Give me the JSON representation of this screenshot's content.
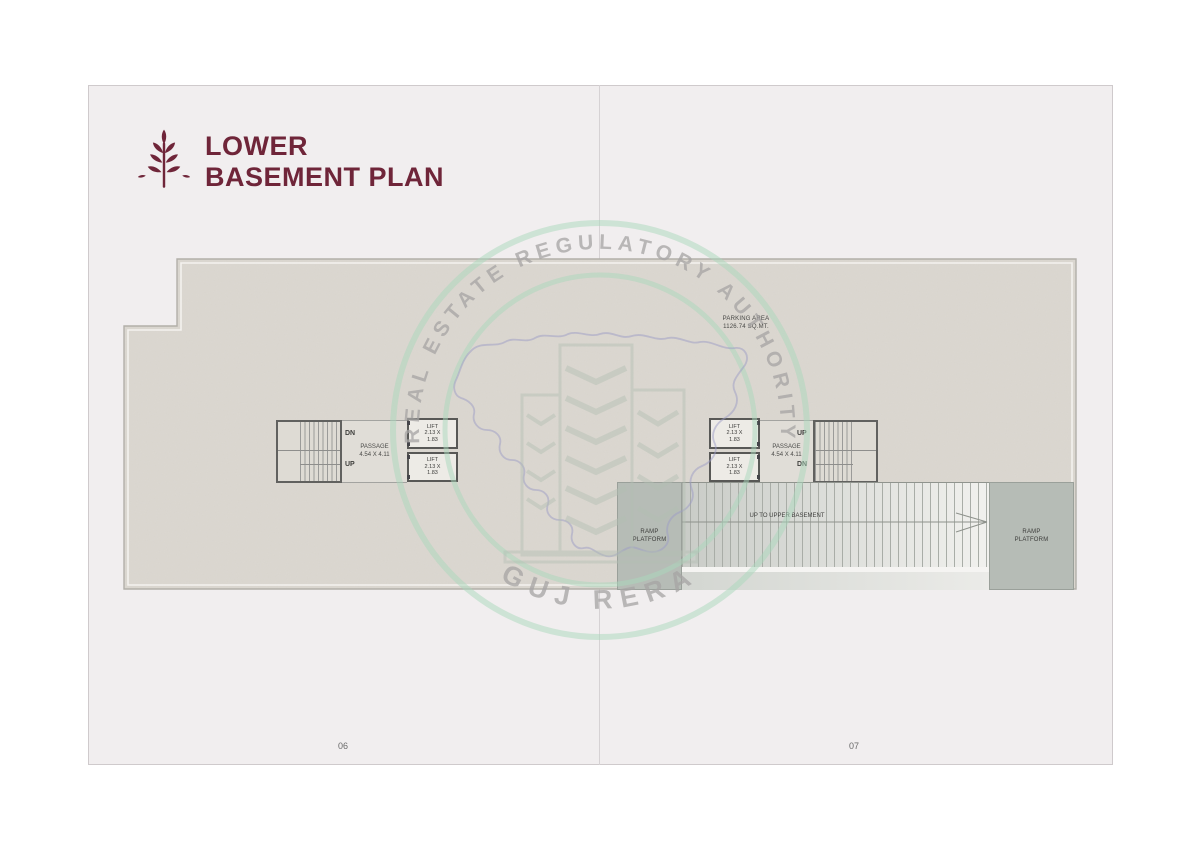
{
  "header": {
    "title_line1": "LOWER",
    "title_line2": "BASEMENT PLAN"
  },
  "watermark": {
    "arc_text": "REAL ESTATE REGULATORY AUTHORITY",
    "bottom_text": "GUJ RERA"
  },
  "colors": {
    "accent_maroon": "#6f2539",
    "watermark_green": "#a9d8bc",
    "plan_fill": "#dcd8d1",
    "platform_fill": "#b6bcb6",
    "wall": "#585856"
  },
  "plan": {
    "parking": {
      "line1": "PARKING AREA",
      "line2": "1126.74 SQ.MT."
    },
    "left_core": {
      "down_label": "DN",
      "up_label": "UP",
      "passage_line1": "PASSAGE",
      "passage_line2": "4.54 X 4.11"
    },
    "right_core": {
      "up_label": "UP",
      "down_label": "DN",
      "passage_line1": "PASSAGE",
      "passage_line2": "4.54 X 4.11"
    },
    "lift": {
      "name": "LIFT",
      "dim_line1": "2.13 X",
      "dim_line2": "1.83"
    },
    "ramp": {
      "left_platform_line1": "RAMP",
      "left_platform_line2": "PLATFORM",
      "direction_text": "UP TO UPPER BASEMENT",
      "right_platform_line1": "RAMP",
      "right_platform_line2": "PLATFORM"
    }
  },
  "footer": {
    "left_page_number": "06",
    "right_page_number": "07"
  }
}
